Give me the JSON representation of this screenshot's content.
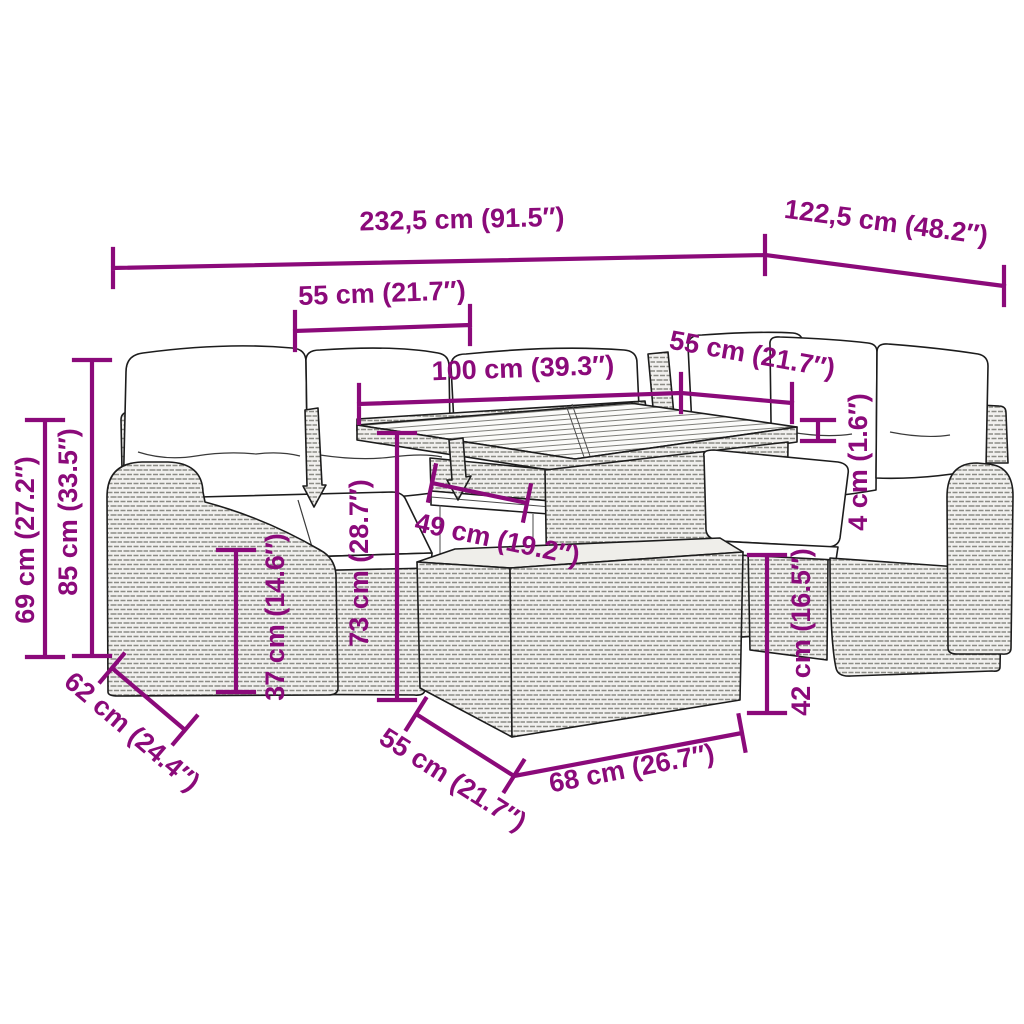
{
  "diagram": {
    "type": "product-dimension-diagram",
    "subject": "poly rattan garden lounge set with cushions, slatted table and ottoman",
    "accent_color": "#8B0A7A",
    "line_color": "#1c1c1c",
    "background_color": "#ffffff",
    "furniture_parts": [
      "corner sofa with back cushions",
      "left armrest",
      "slatted-top table with under shelf",
      "ottoman",
      "armchair with cushions",
      "right armrest"
    ],
    "dimensions": {
      "total_length_left": "232,5 cm (91.5″)",
      "total_length_right": "122,5 cm (48.2″)",
      "seat_width_left": "55 cm (21.7″)",
      "table_length": "100 cm (39.3″)",
      "seat_width_right": "55 cm (21.7″)",
      "armrest_height": "69 cm (27.2″)",
      "backrest_height": "85 cm (33.5″)",
      "seat_height": "37 cm (14.6″)",
      "table_height": "73 cm (28.7″)",
      "shelf_clearance": "49 cm (19.2″)",
      "tabletop_thickness": "4 cm (1.6″)",
      "ottoman_height": "42 cm (16.5″)",
      "seat_depth": "62 cm (24.4″)",
      "ottoman_depth": "55 cm (21.7″)",
      "ottoman_width": "68 cm (26.7″)"
    }
  }
}
